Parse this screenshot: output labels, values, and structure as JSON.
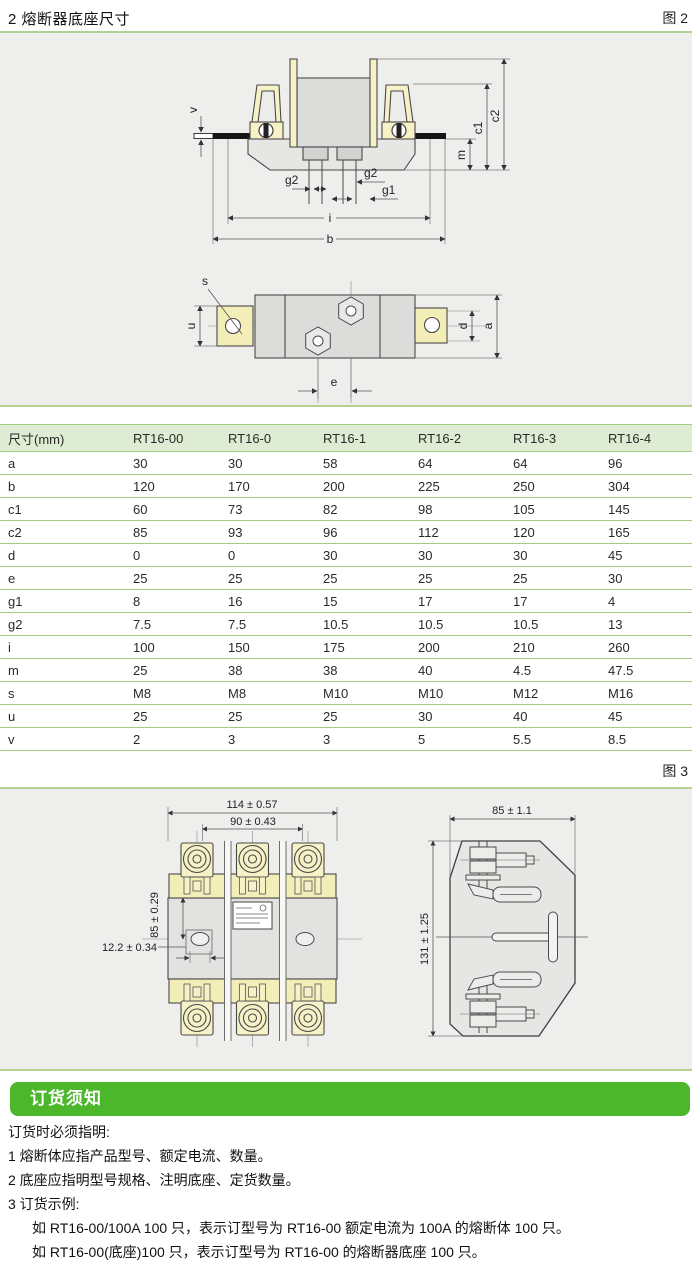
{
  "page": {
    "section_title": "2 熔断器底座尺寸",
    "figure2_label": "图 2",
    "figure3_label": "图 3"
  },
  "colors": {
    "accent_green": "#4cb72b",
    "rule_green": "#b2d193",
    "table_line_green": "#a3cb81",
    "table_header_bg": "#ddecd2",
    "panel_gray": "#eeeeec",
    "drawing_cream": "#f6f1c6",
    "drawing_gray": "#e2e2e0"
  },
  "figures": {
    "front_view": {
      "dims": {
        "v": "v",
        "g2_left": "g2",
        "g2_right": "g2",
        "g1": "g1",
        "i": "i",
        "b": "b",
        "m": "m",
        "c1": "c1",
        "c2": "c2"
      }
    },
    "top_view": {
      "dims": {
        "s": "s",
        "u": "u",
        "e": "e",
        "d": "d",
        "a": "a"
      }
    },
    "fig3_front": {
      "dims": {
        "width_outer": "114 ± 0.57",
        "width_inner": "90 ± 0.43",
        "height": "85 ± 0.29",
        "hole": "12.2 ± 0.34"
      }
    },
    "fig3_side": {
      "dims": {
        "width": "85 ± 1.1",
        "height": "131 ± 1.25"
      }
    }
  },
  "table": {
    "columns": [
      "尺寸(mm)",
      "RT16-00",
      "RT16-0",
      "RT16-1",
      "RT16-2",
      "RT16-3",
      "RT16-4"
    ],
    "rows": [
      {
        "label": "a",
        "values": [
          "30",
          "30",
          "58",
          "64",
          "64",
          "96"
        ]
      },
      {
        "label": "b",
        "values": [
          "120",
          "170",
          "200",
          "225",
          "250",
          "304"
        ]
      },
      {
        "label": "c1",
        "values": [
          "60",
          "73",
          "82",
          "98",
          "105",
          "145"
        ]
      },
      {
        "label": "c2",
        "values": [
          "85",
          "93",
          "96",
          "112",
          "120",
          "165"
        ]
      },
      {
        "label": "d",
        "values": [
          "0",
          "0",
          "30",
          "30",
          "30",
          "45"
        ]
      },
      {
        "label": "e",
        "values": [
          "25",
          "25",
          "25",
          "25",
          "25",
          "30"
        ]
      },
      {
        "label": "g1",
        "values": [
          "8",
          "16",
          "15",
          "17",
          "17",
          "4"
        ]
      },
      {
        "label": "g2",
        "values": [
          "7.5",
          "7.5",
          "10.5",
          "10.5",
          "10.5",
          "13"
        ]
      },
      {
        "label": "i",
        "values": [
          "100",
          "150",
          "175",
          "200",
          "210",
          "260"
        ]
      },
      {
        "label": "m",
        "values": [
          "25",
          "38",
          "38",
          "40",
          "4.5",
          "47.5"
        ]
      },
      {
        "label": "s",
        "values": [
          "M8",
          "M8",
          "M10",
          "M10",
          "M12",
          "M16"
        ]
      },
      {
        "label": "u",
        "values": [
          "25",
          "25",
          "25",
          "30",
          "40",
          "45"
        ]
      },
      {
        "label": "v",
        "values": [
          "2",
          "3",
          "3",
          "5",
          "5.5",
          "8.5"
        ]
      }
    ]
  },
  "ordering": {
    "banner": "订货须知",
    "intro": "订货时必须指明:",
    "items": [
      "1 熔断体应指产品型号、额定电流、数量。",
      "2 底座应指明型号规格、注明底座、定货数量。",
      "3 订货示例:"
    ],
    "examples": [
      "如 RT16-00/100A  100 只，表示订型号为 RT16-00 额定电流为 100A 的熔断体 100 只。",
      "如 RT16-00(底座)100 只，表示订型号为 RT16-00 的熔断器底座 100 只。"
    ]
  }
}
